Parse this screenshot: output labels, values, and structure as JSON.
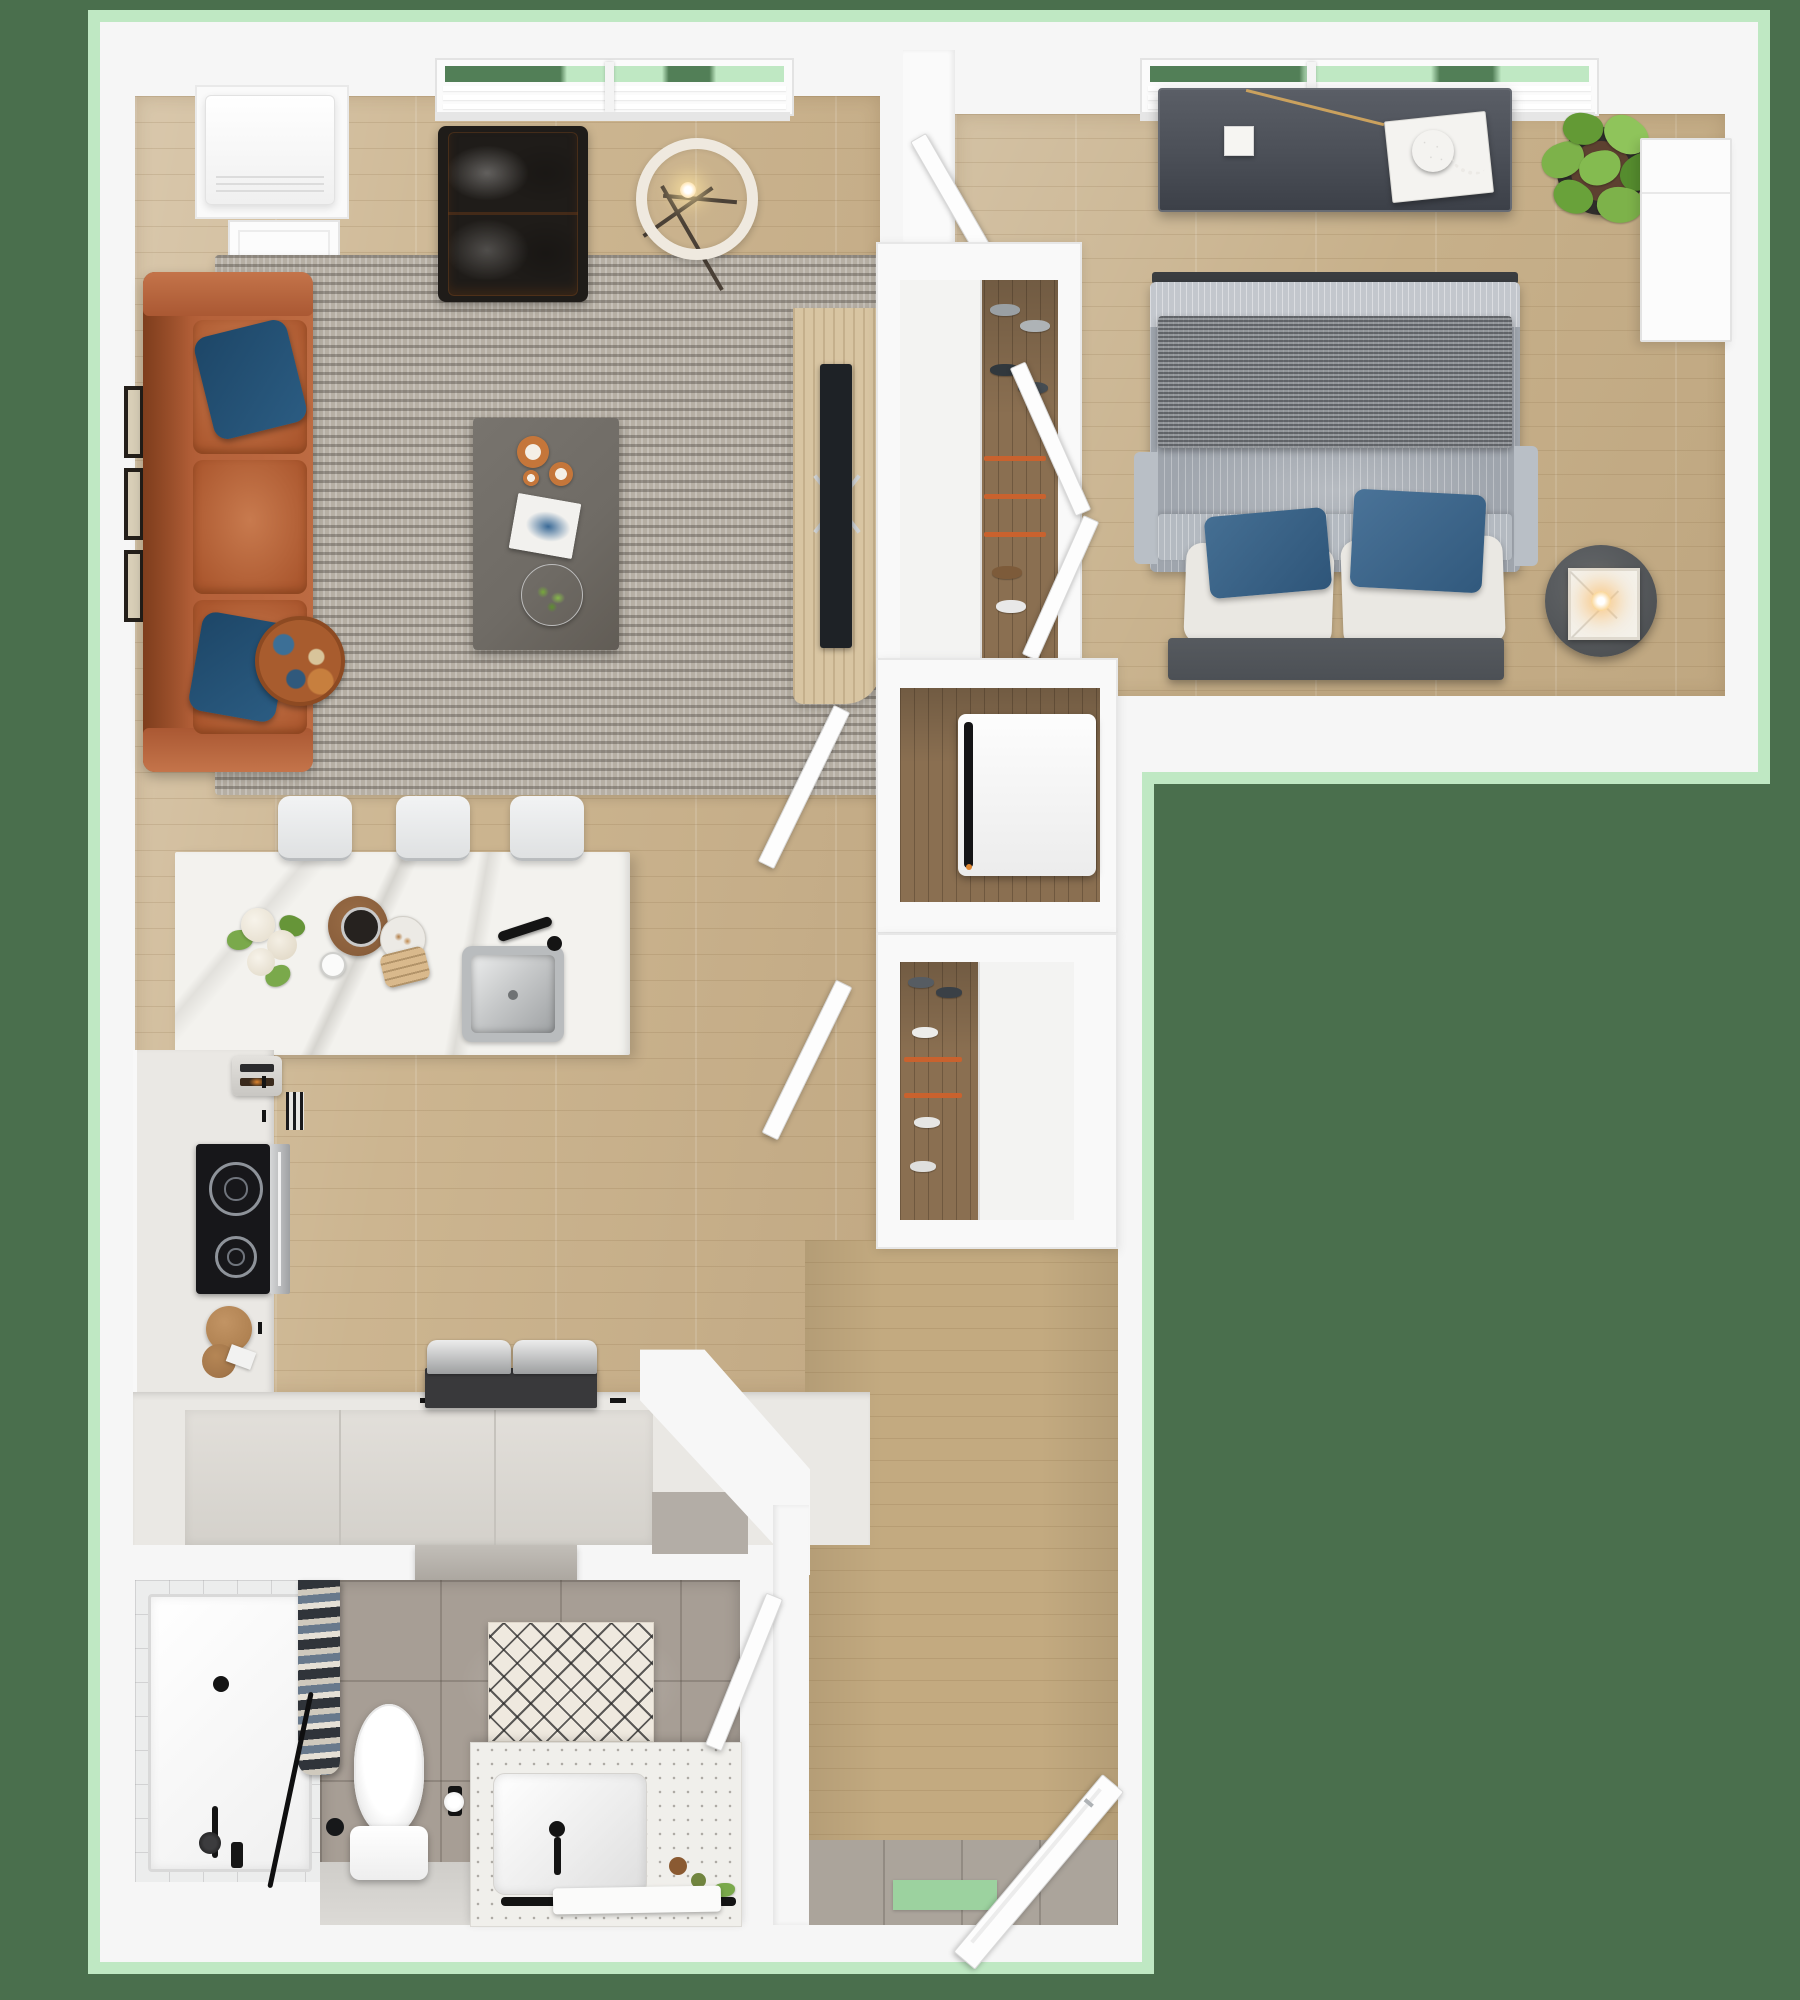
{
  "title": "3d-apartment-floor-plan-top-view",
  "colors": {
    "bg": "#4a6f4d",
    "glow": "#bfe8c3",
    "green-deep": "#527f57",
    "mat": "#f6f6f6",
    "wood": "#ccb590",
    "wood-bed": "#c7b08a",
    "wood-dark": "#8a6f51",
    "wood-entry": "#c3aa80",
    "rug": "#b6afa4",
    "rug-stripe": "#6f6962",
    "sofa": "#b5613a",
    "sofa-dark": "#9c4e27",
    "pillow-navy": "#1d4667",
    "chair": "#cd8a56",
    "coffee-table": "#6f6b65",
    "tv-console-wood": "#d8c5a2",
    "tv-black": "#1e2226",
    "marble": "#f3f2ee",
    "counter": "#eae8e4",
    "cooktop": "#17171a",
    "steel": "#b9bcbe",
    "duvet": "#9fa5ad",
    "duvet-light": "#c3c7cd",
    "throw": "#7f8388",
    "pillow-white": "#eae8e3",
    "pillow-blue": "#35608523",
    "headboard": "#4c5055",
    "console-gray": "#4b4f57",
    "plant-green": "#7db24a",
    "bath-tile": "#a79e95",
    "terrazzo": "#f0efeb",
    "entry-tile": "#aba49b",
    "door-mat-green": "#9cd29f",
    "fixture-black": "#141414"
  },
  "rooms": [
    {
      "name": "living-room"
    },
    {
      "name": "bedroom"
    },
    {
      "name": "walk-in-closet"
    },
    {
      "name": "laundry-closet"
    },
    {
      "name": "linen-closet"
    },
    {
      "name": "kitchen"
    },
    {
      "name": "bathroom"
    },
    {
      "name": "entry-hall"
    }
  ],
  "furniture": [
    {
      "name": "leather-sofa"
    },
    {
      "name": "navy-throw-pillows"
    },
    {
      "name": "patterned-round-pillow"
    },
    {
      "name": "area-rug"
    },
    {
      "name": "tufted-lounge-chair"
    },
    {
      "name": "ring-floor-lamp"
    },
    {
      "name": "coffee-table"
    },
    {
      "name": "copper-candles"
    },
    {
      "name": "art-book"
    },
    {
      "name": "decor-plate"
    },
    {
      "name": "gallery-wall-frames"
    },
    {
      "name": "tv-console"
    },
    {
      "name": "wall-tv"
    },
    {
      "name": "kitchen-island"
    },
    {
      "name": "island-sink"
    },
    {
      "name": "bar-stools"
    },
    {
      "name": "flower-vase"
    },
    {
      "name": "serving-tray"
    },
    {
      "name": "toaster"
    },
    {
      "name": "cooktop"
    },
    {
      "name": "oven"
    },
    {
      "name": "cutting-boards"
    },
    {
      "name": "counter-appliance"
    },
    {
      "name": "double-bed"
    },
    {
      "name": "bed-throw-blanket"
    },
    {
      "name": "bed-pillows"
    },
    {
      "name": "headboard-bench"
    },
    {
      "name": "dresser-console"
    },
    {
      "name": "decor-tray"
    },
    {
      "name": "potted-plant"
    },
    {
      "name": "wardrobe"
    },
    {
      "name": "bedside-table"
    },
    {
      "name": "glowing-lamp"
    },
    {
      "name": "washing-machine"
    },
    {
      "name": "closet-doors"
    },
    {
      "name": "shoe-shelves"
    },
    {
      "name": "walk-in-shower"
    },
    {
      "name": "shower-curtain"
    },
    {
      "name": "toilet"
    },
    {
      "name": "lattice-bath-mat"
    },
    {
      "name": "vanity-sink"
    },
    {
      "name": "towel-bar"
    },
    {
      "name": "towel"
    },
    {
      "name": "entry-door"
    },
    {
      "name": "green-door-mat"
    },
    {
      "name": "refrigerator"
    },
    {
      "name": "living-room-window"
    },
    {
      "name": "bedroom-window"
    }
  ]
}
